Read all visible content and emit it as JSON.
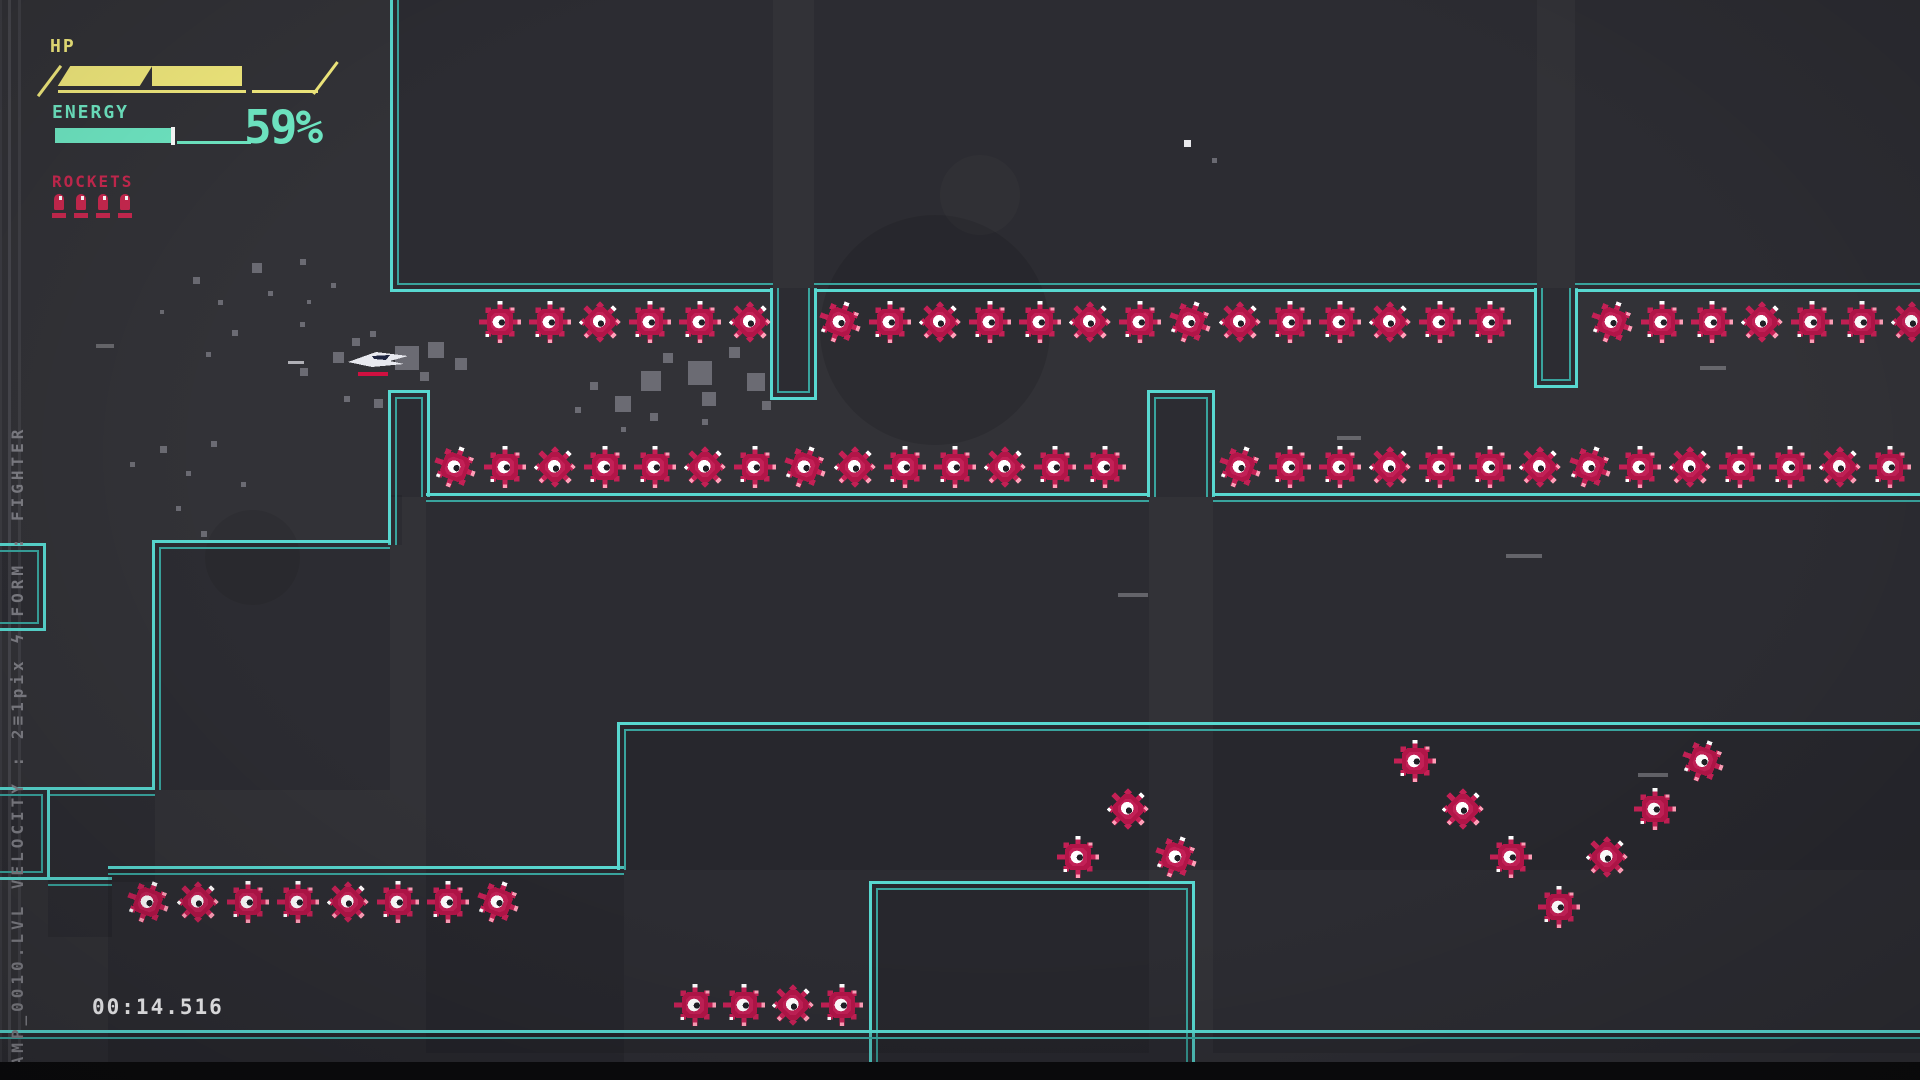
{
  "hud": {
    "hp_label": "HP",
    "hp_segments_total": 3,
    "hp_segments_filled": 2,
    "energy_label": "ENERGY",
    "energy_percent": "59%",
    "energy_fill_ratio": 0.59,
    "rockets_label": "ROCKETS",
    "rocket_count": 4,
    "timer": "00:14.516"
  },
  "sidebar": {
    "status_text": "CAMP_0010.LVL     VELOCITY : 2≡1pix   ϟ     FORM : FIGHTER"
  },
  "colors": {
    "bg": "#323237",
    "cyan_bright": "#58d8d0",
    "cyan_dim": "#39a39d",
    "hp_yellow": "#f2ea7d",
    "energy_mint": "#6fe8c4",
    "rocket_crimson": "#c8284f",
    "enemy_body": "#b21548",
    "enemy_accent": "#cf2a62",
    "enemy_tip": "#ff9fb8",
    "timer_white": "#f0f0f2",
    "side_text_gray": "#7e7e85",
    "particle_gray": "#76767e"
  },
  "level": {
    "walls": [
      {
        "x": 390,
        "y": -20,
        "w": 383,
        "h": 312,
        "b": "lb"
      },
      {
        "x": 770,
        "y": 288,
        "w": 47,
        "h": 112,
        "b": "lrb"
      },
      {
        "x": 814,
        "y": -20,
        "w": 723,
        "h": 312,
        "b": "b"
      },
      {
        "x": 1534,
        "y": 288,
        "w": 44,
        "h": 100,
        "b": "lrb"
      },
      {
        "x": 1575,
        "y": -20,
        "w": 365,
        "h": 312,
        "b": "b"
      },
      {
        "x": 388,
        "y": 390,
        "w": 42,
        "h": 107,
        "b": "tlr"
      },
      {
        "x": 388,
        "y": 495,
        "w": 14,
        "h": 50,
        "b": "l"
      },
      {
        "x": 426,
        "y": 493,
        "w": 723,
        "h": 560,
        "b": "t"
      },
      {
        "x": 1147,
        "y": 390,
        "w": 68,
        "h": 107,
        "b": "tlr"
      },
      {
        "x": 1213,
        "y": 493,
        "w": 727,
        "h": 560,
        "b": "t"
      },
      {
        "x": 152,
        "y": 540,
        "w": 238,
        "h": 250,
        "b": "tl"
      },
      {
        "x": 48,
        "y": 787,
        "w": 107,
        "h": 95,
        "b": "t"
      },
      {
        "x": -10,
        "y": 543,
        "w": 56,
        "h": 88,
        "b": "trb"
      },
      {
        "x": -10,
        "y": 787,
        "w": 60,
        "h": 93,
        "b": "trb"
      },
      {
        "x": 48,
        "y": 877,
        "w": 64,
        "h": 60,
        "b": "t"
      },
      {
        "x": 108,
        "y": 866,
        "w": 516,
        "h": 216,
        "b": "t"
      },
      {
        "x": 617,
        "y": 722,
        "w": 1323,
        "h": 148,
        "b": "tl"
      },
      {
        "x": 869,
        "y": 881,
        "w": 326,
        "h": 210,
        "b": "tlr"
      },
      {
        "x": -10,
        "y": 1030,
        "w": 1960,
        "h": 70,
        "b": "t"
      }
    ],
    "enemy_rows": [
      {
        "x": 500,
        "y": 322,
        "count": 6,
        "step": 50
      },
      {
        "x": 840,
        "y": 322,
        "count": 14,
        "step": 50
      },
      {
        "x": 1612,
        "y": 322,
        "count": 7,
        "step": 50
      },
      {
        "x": 455,
        "y": 467,
        "count": 14,
        "step": 50
      },
      {
        "x": 1240,
        "y": 467,
        "count": 14,
        "step": 50
      },
      {
        "x": 148,
        "y": 902,
        "count": 8,
        "step": 50
      },
      {
        "x": 695,
        "y": 1005,
        "count": 4,
        "step": 49
      }
    ],
    "enemy_singles": [
      [
        1078,
        857
      ],
      [
        1128,
        809
      ],
      [
        1176,
        857
      ],
      [
        1415,
        761
      ],
      [
        1463,
        809
      ],
      [
        1511,
        857
      ],
      [
        1559,
        907
      ],
      [
        1607,
        857
      ],
      [
        1655,
        809
      ],
      [
        1703,
        761
      ]
    ],
    "ship": {
      "x": 346,
      "y": 344
    },
    "trail": [
      288,
      361,
      16,
      3
    ],
    "particles": [
      [
        193,
        277,
        7
      ],
      [
        218,
        300,
        5
      ],
      [
        252,
        263,
        10
      ],
      [
        300,
        259,
        6
      ],
      [
        268,
        291,
        5
      ],
      [
        232,
        330,
        6
      ],
      [
        206,
        352,
        5
      ],
      [
        307,
        300,
        4
      ],
      [
        331,
        283,
        5
      ],
      [
        160,
        310,
        4
      ],
      [
        300,
        368,
        8
      ],
      [
        333,
        352,
        11
      ],
      [
        352,
        338,
        8
      ],
      [
        370,
        331,
        6
      ],
      [
        395,
        346,
        24
      ],
      [
        428,
        342,
        16
      ],
      [
        420,
        372,
        9
      ],
      [
        455,
        358,
        12
      ],
      [
        344,
        396,
        6
      ],
      [
        374,
        399,
        9
      ],
      [
        300,
        322,
        5
      ],
      [
        590,
        382,
        8
      ],
      [
        615,
        396,
        16
      ],
      [
        641,
        371,
        20
      ],
      [
        663,
        353,
        10
      ],
      [
        688,
        361,
        24
      ],
      [
        702,
        392,
        14
      ],
      [
        729,
        347,
        11
      ],
      [
        747,
        373,
        18
      ],
      [
        762,
        401,
        9
      ],
      [
        650,
        413,
        8
      ],
      [
        702,
        419,
        6
      ],
      [
        575,
        407,
        6
      ],
      [
        621,
        427,
        5
      ],
      [
        130,
        462,
        5
      ],
      [
        160,
        446,
        7
      ],
      [
        186,
        471,
        5
      ],
      [
        211,
        441,
        6
      ],
      [
        176,
        506,
        5
      ],
      [
        201,
        531,
        6
      ],
      [
        241,
        482,
        5
      ],
      [
        1212,
        158,
        5
      ]
    ],
    "dashes": [
      [
        1118,
        593,
        30
      ],
      [
        1506,
        554,
        36
      ],
      [
        1638,
        773,
        30
      ],
      [
        1700,
        366,
        26
      ],
      [
        1337,
        436,
        24
      ],
      [
        96,
        344,
        18
      ]
    ],
    "white_specks": [
      [
        1184,
        140,
        7
      ]
    ],
    "faint_circles": [
      [
        820,
        215,
        230,
        "rgba(0,0,0,0.10)"
      ],
      [
        205,
        510,
        95,
        "rgba(0,0,0,0.07)"
      ],
      [
        940,
        155,
        80,
        "rgba(255,255,255,0.025)"
      ]
    ],
    "gray_boundary_lines": [
      {
        "x": 0,
        "w": 2,
        "c": "#3c3c42"
      },
      {
        "x": 8,
        "w": 3,
        "c": "#47474d"
      },
      {
        "x": 18,
        "w": 3,
        "c": "#404046"
      }
    ]
  }
}
